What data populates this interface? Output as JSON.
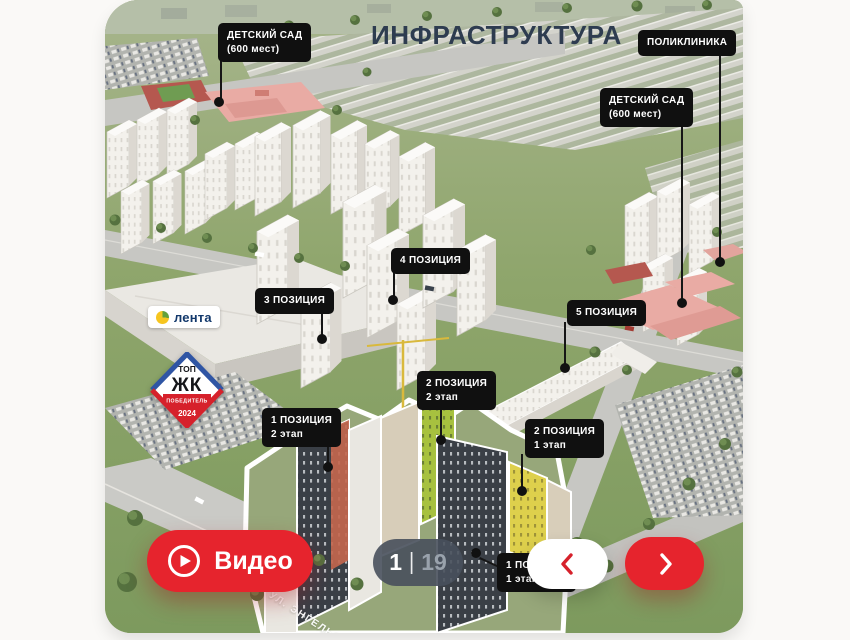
{
  "header": {
    "title": "ИНФРАСТРУКТУРА"
  },
  "labels": {
    "kindergarten_left": {
      "line1": "ДЕТСКИЙ САД",
      "line2": "(600 мест)"
    },
    "polyclinic": {
      "line1": "ПОЛИКЛИНИКА"
    },
    "kindergarten_right": {
      "line1": "ДЕТСКИЙ САД",
      "line2": "(600 мест)"
    },
    "position3": {
      "line1": "3 ПОЗИЦИЯ"
    },
    "position4": {
      "line1": "4 ПОЗИЦИЯ"
    },
    "position5": {
      "line1": "5 ПОЗИЦИЯ"
    },
    "position2_stage2": {
      "line1": "2 ПОЗИЦИЯ",
      "line2": "2 этап"
    },
    "position2_stage1": {
      "line1": "2 ПОЗИЦИЯ",
      "line2": "1 этап"
    },
    "position1_stage2": {
      "line1": "1 ПОЗИЦИЯ",
      "line2": "2 этап"
    },
    "position1_stage1": {
      "line1": "1 ПОЗИЦИЯ",
      "line2": "1 этап"
    }
  },
  "street": {
    "name": "УЛ. ЭНГЕЛЬСА"
  },
  "lenta": {
    "text": "лента"
  },
  "badge": {
    "top": "ТОП",
    "zhk": "ЖК",
    "ribbon": "ПОБЕДИТЕЛЬ",
    "year": "2024"
  },
  "video": {
    "label": "Видео"
  },
  "pager": {
    "current": "1",
    "separator": "|",
    "total": "19"
  },
  "icons": {
    "video": "play-circle-icon",
    "prev": "chevron-left-icon",
    "next": "chevron-right-icon"
  },
  "colors": {
    "accent_red": "#e6242d",
    "label_bg": "#101010",
    "title_text": "#2e3c50",
    "pager_bg": "#4a525e",
    "pager_total_text": "#99a2ac",
    "lenta_text": "#12386b",
    "badge_red": "#d6212b",
    "badge_blue": "#2f55a4"
  }
}
